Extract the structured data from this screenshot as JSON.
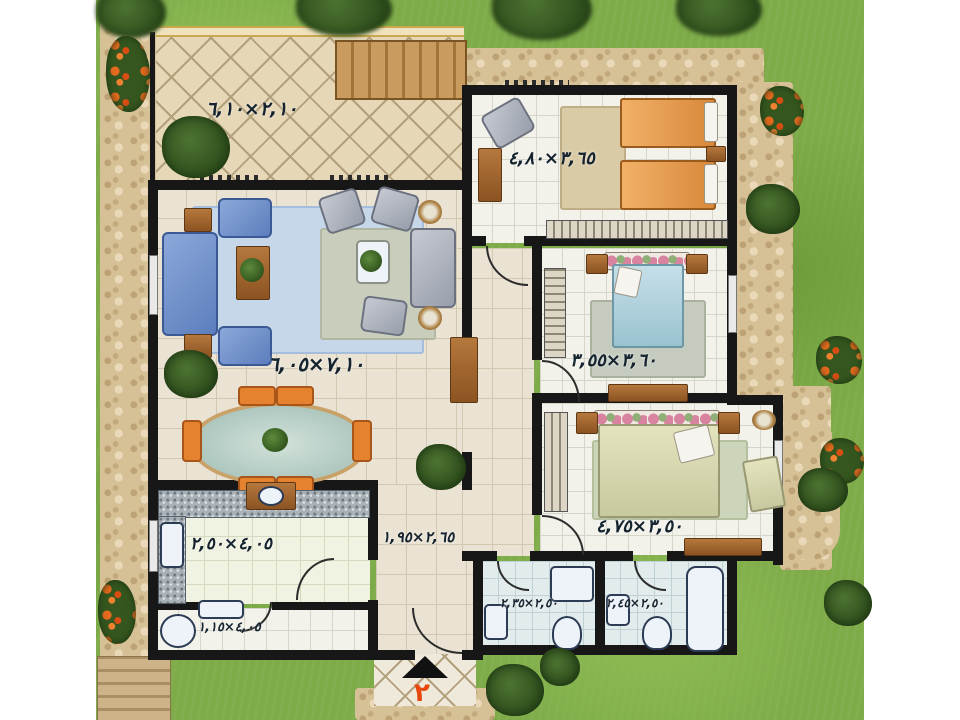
{
  "plan": {
    "unit_number": "٢",
    "rooms": {
      "terrace": {
        "dim": "٢,١٠×٦,١٠"
      },
      "living": {
        "dim": "٧,١٠×٦,٠٥"
      },
      "bedroom1": {
        "dim": "٣,٦٥×٤,٨٠"
      },
      "bedroom2": {
        "dim": "٣,٦٠×٣,٥٥"
      },
      "bedroom3": {
        "dim": "٣,٥٠×٤,٧٥"
      },
      "kitchen": {
        "dim": "٤,٠٥×٢,٥٠"
      },
      "hall": {
        "dim": "٢,٦٥×١,٩٥"
      },
      "service": {
        "dim": "٤,٠٥×١,١٥"
      },
      "bath1": {
        "dim": "٢,٥٠×٢,٣٥"
      },
      "bath2": {
        "dim": "٢,٥٠×٢,٤٥"
      }
    },
    "colors": {
      "grass": "#7dab48",
      "stone_path": "#d6c196",
      "wall": "#171717",
      "entrance_number": "#e8480c",
      "blue_sofa": "#6d8fc6",
      "orange_bed": "#e59a4e",
      "blue_bed": "#a9cdd9",
      "cream_bed": "#d9d9b3"
    }
  }
}
